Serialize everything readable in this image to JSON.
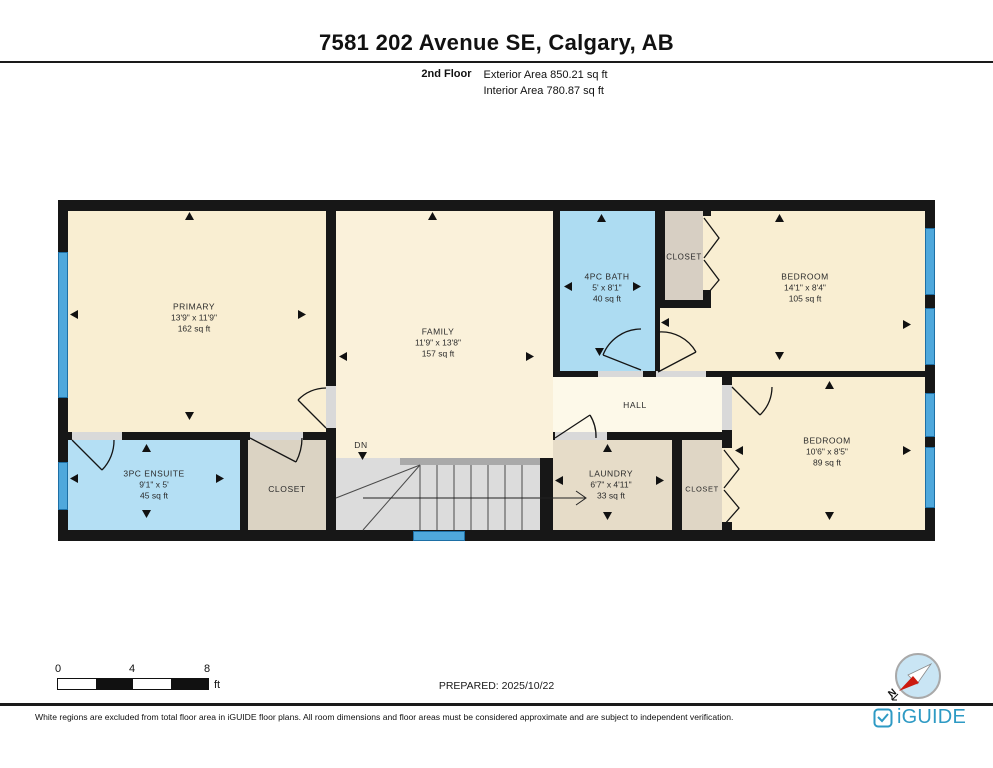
{
  "header": {
    "title": "7581 202 Avenue SE, Calgary, AB",
    "floor_label": "2nd Floor",
    "exterior_area": "Exterior Area 850.21 sq ft",
    "interior_area": "Interior Area 780.87 sq ft"
  },
  "rooms": [
    {
      "name": "PRIMARY",
      "dims": "13'9\" x 11'9\"",
      "area": "162 sq ft"
    },
    {
      "name": "FAMILY",
      "dims": "11'9\" x 13'8\"",
      "area": "157 sq ft"
    },
    {
      "name": "4PC BATH",
      "dims": "5' x 8'1\"",
      "area": "40 sq ft"
    },
    {
      "name": "3PC ENSUITE",
      "dims": "9'1\" x 5'",
      "area": "45 sq ft"
    },
    {
      "name": "BEDROOM",
      "dims": "14'1\" x 8'4\"",
      "area": "105 sq ft"
    },
    {
      "name": "BEDROOM",
      "dims": "10'6\" x 8'5\"",
      "area": "89 sq ft"
    },
    {
      "name": "LAUNDRY",
      "dims": "6'7\" x 4'11\"",
      "area": "33 sq ft"
    }
  ],
  "labels": {
    "closet": "CLOSET",
    "hall": "HALL",
    "dn": "DN",
    "north": "N"
  },
  "scale_bar": {
    "ticks": [
      "0",
      "4",
      "8"
    ],
    "unit": "ft"
  },
  "prepared": "PREPARED: 2025/10/22",
  "footer": {
    "disclaimer": "White regions are excluded from total floor area in iGUIDE floor plans. All room dimensions and floor areas must be considered approximate and are subject to independent verification.",
    "brand": "iGUIDE"
  },
  "colors": {
    "wall": "#171717",
    "room_beige": "#F9EED2",
    "family_beige": "#FAF1DA",
    "hall_cream": "#FDF9E9",
    "bath_blue": "#ADDCF2",
    "ensuite_blue": "#B4DFF4",
    "closet_tan": "#DBD3C3",
    "laundry_tan": "#E6DCC8",
    "stairs_gray": "#DCDCDC",
    "window_blue": "#4FA8DC",
    "brand_blue": "#2E9AC4"
  }
}
